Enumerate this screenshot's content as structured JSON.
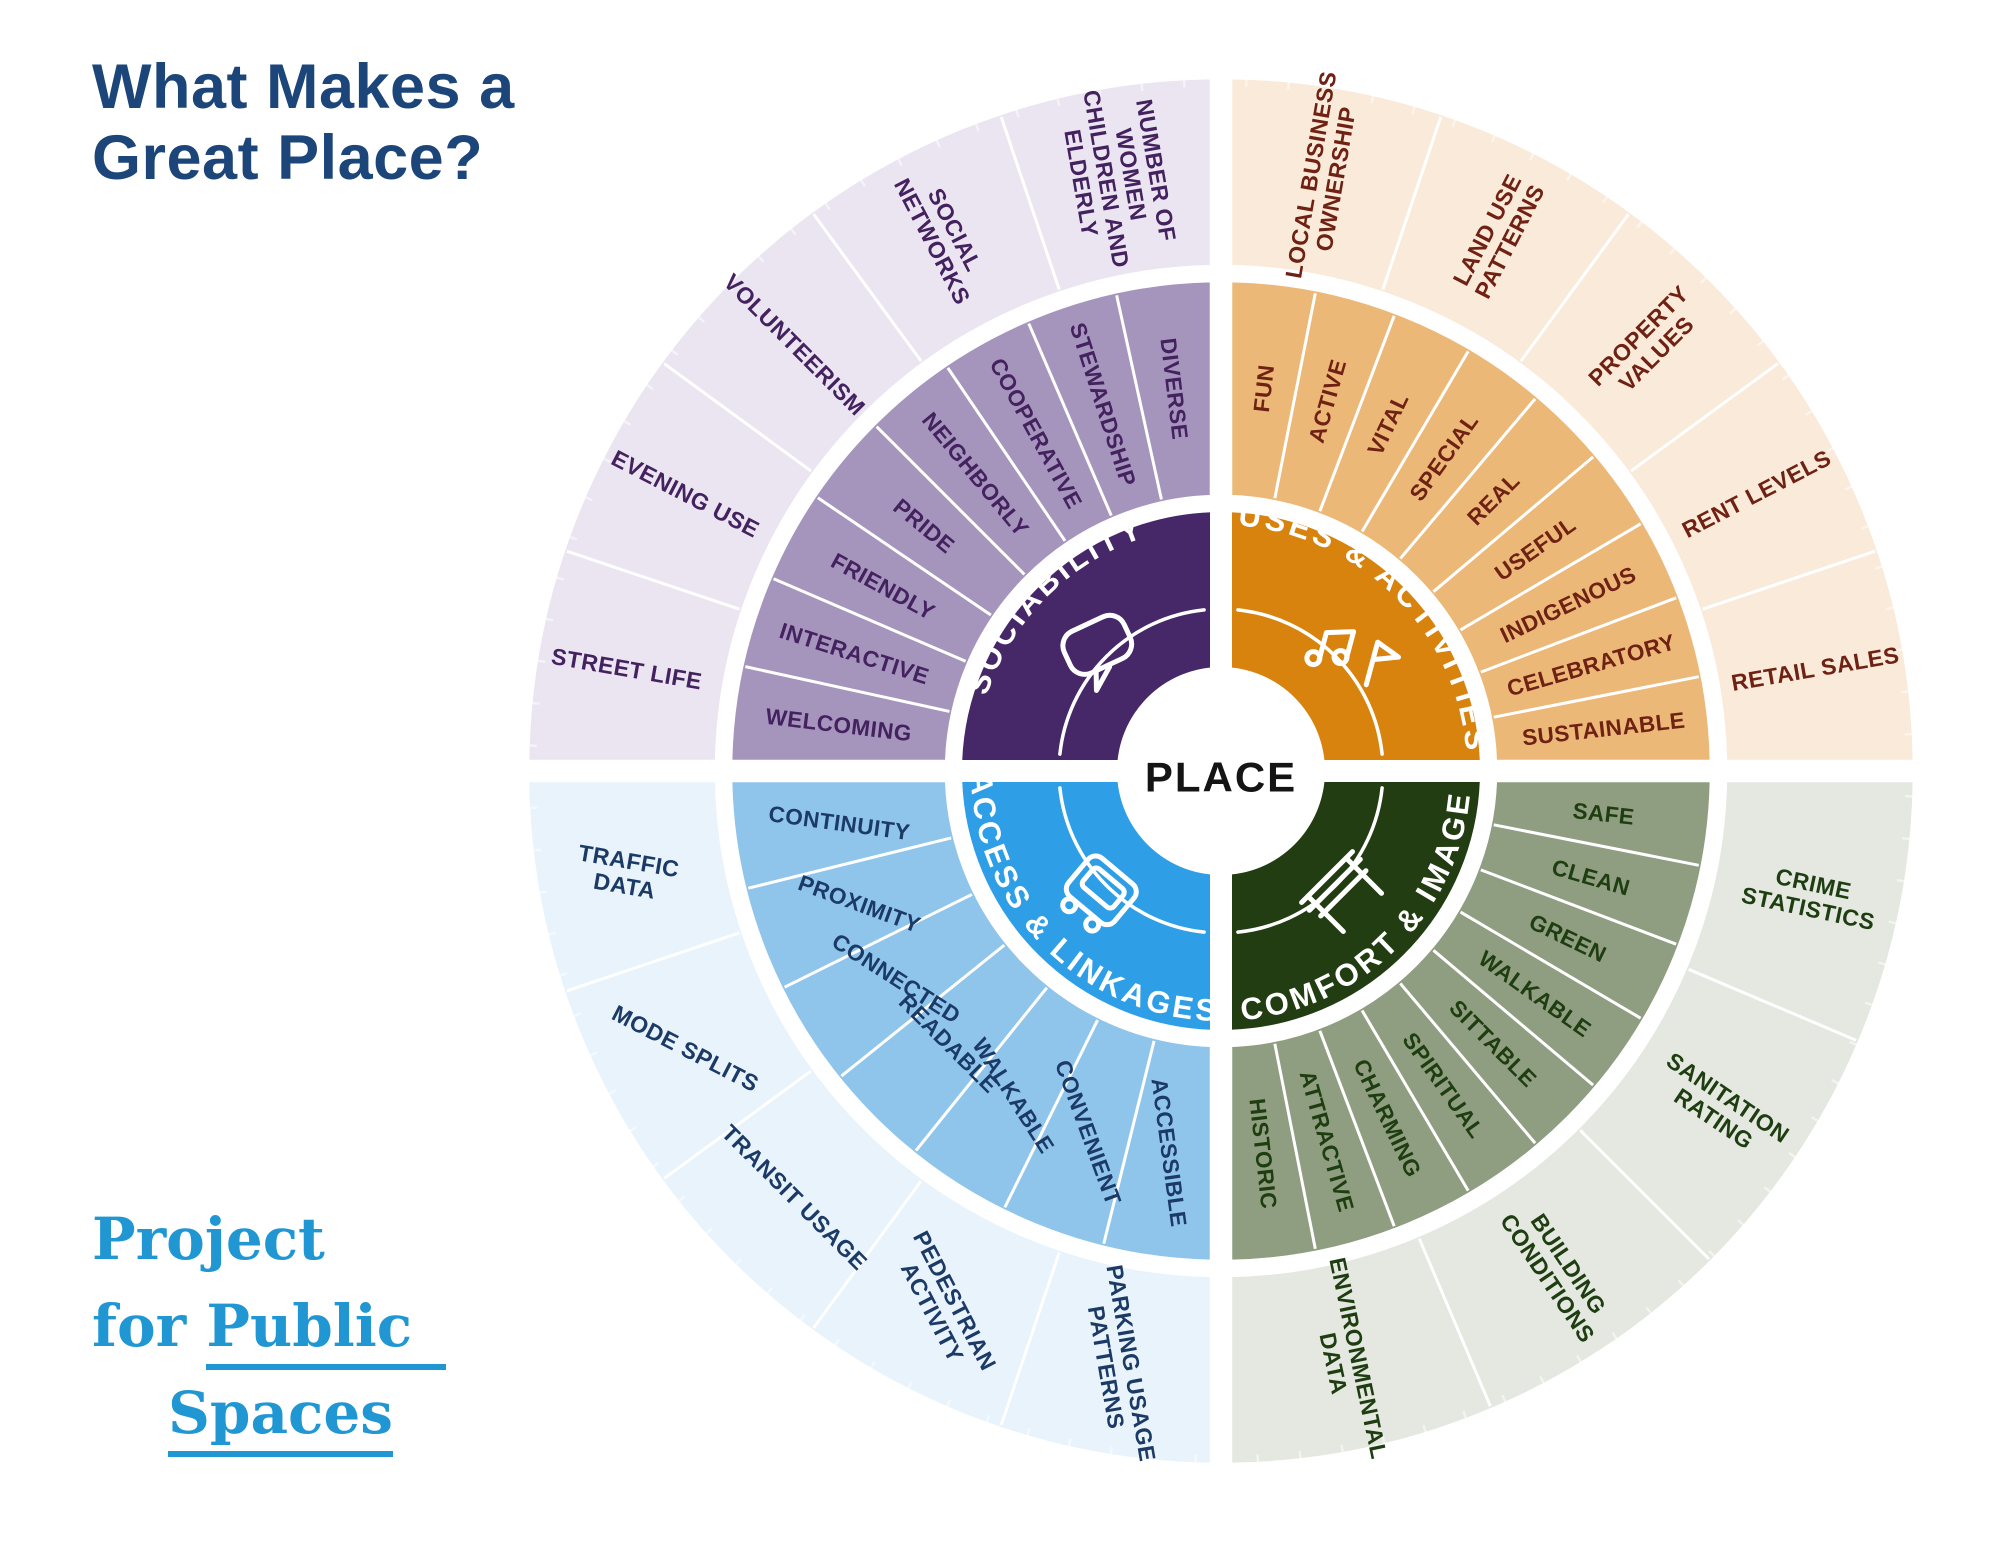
{
  "title": {
    "line1": "What Makes a",
    "line2": "Great Place?"
  },
  "center": {
    "label": "PLACE"
  },
  "logo": {
    "word1": "Project",
    "word2": "for",
    "word3": "Public",
    "word4": "Spaces",
    "color": "#2097d3"
  },
  "colors": {
    "background": "#ffffff",
    "title_text": "#1c4679",
    "place_text": "#141414",
    "separator": "#ffffff",
    "logo_blue": "#2097d3"
  },
  "quadrants": [
    {
      "position": "top-right",
      "title": "USES & ACTIVITIES",
      "icon": "music-notes-flag-icon",
      "inner_color": "#d8830e",
      "middle_color": "#ecb878",
      "outer_color": "#faead9",
      "label_color": "#6f2113",
      "title_color": "#ffffff",
      "intangibles": [
        "FUN",
        "ACTIVE",
        "VITAL",
        "SPECIAL",
        "REAL",
        "USEFUL",
        "INDIGENOUS",
        "CELEBRATORY",
        "SUSTAINABLE"
      ],
      "measurements": [
        "LOCAL BUSINESS|OWNERSHIP",
        "LAND USE|PATTERNS",
        "PROPERTY|VALUES",
        "RENT LEVELS",
        "RETAIL SALES"
      ]
    },
    {
      "position": "bottom-right",
      "title": "COMFORT & IMAGE",
      "icon": "bench-icon",
      "inner_color": "#213d11",
      "middle_color": "#8f9d81",
      "outer_color": "#e4e8e0",
      "label_color": "#1e3d10",
      "title_color": "#ffffff",
      "intangibles": [
        "SAFE",
        "CLEAN",
        "GREEN",
        "WALKABLE",
        "SITTABLE",
        "SPIRITUAL",
        "CHARMING",
        "ATTRACTIVE",
        "HISTORIC"
      ],
      "measurements": [
        "CRIME|STATISTICS",
        "SANITATION|RATING",
        "BUILDING|CONDITIONS",
        "ENVIRONMENTAL|DATA"
      ]
    },
    {
      "position": "bottom-left",
      "title": "ACCESS & LINKAGES",
      "icon": "bus-icon",
      "inner_color": "#2e9ee6",
      "middle_color": "#90c5eb",
      "outer_color": "#e8f3fc",
      "label_color": "#1b3a66",
      "title_color": "#ffffff",
      "intangibles": [
        "ACCESSIBLE",
        "CONVENIENT",
        "WALKABLE",
        "READABLE",
        "CONNECTED",
        "PROXIMITY",
        "CONTINUITY"
      ],
      "measurements": [
        "PARKING USAGE|PATTERNS",
        "PEDESTRIAN|ACTIVITY",
        "TRANSIT USAGE",
        "MODE SPLITS",
        "TRAFFIC|DATA"
      ]
    },
    {
      "position": "top-left",
      "title": "SOCIABILITY",
      "icon": "speech-bubble-icon",
      "inner_color": "#462768",
      "middle_color": "#a595bc",
      "outer_color": "#eae5f0",
      "label_color": "#44215f",
      "title_color": "#ffffff",
      "intangibles": [
        "WELCOMING",
        "INTERACTIVE",
        "FRIENDLY",
        "PRIDE",
        "NEIGHBORLY",
        "COOPERATIVE",
        "STEWARDSHIP",
        "DIVERSE"
      ],
      "measurements": [
        "STREET LIFE",
        "EVENING USE",
        "VOLUNTEERISM",
        "SOCIAL|NETWORKS",
        "NUMBER OF|WOMEN|CHILDREN AND|ELDERLY"
      ]
    }
  ]
}
